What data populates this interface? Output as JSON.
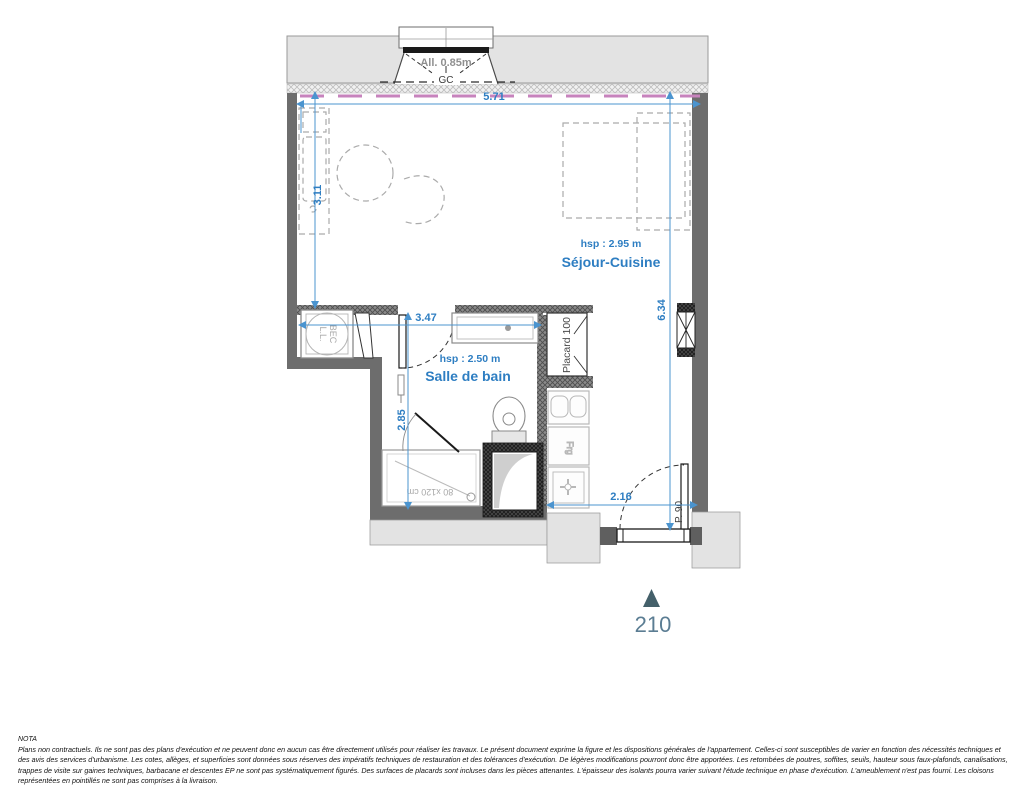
{
  "window": {
    "allege": "All. 0.85m",
    "vent": "GC"
  },
  "rooms": {
    "sejour_label": "Séjour-Cuisine",
    "sejour_hsp": "hsp : 2.95 m",
    "bath_label": "Salle de bain",
    "bath_hsp": "hsp : 2.50 m",
    "placard_label": "Placard 100",
    "fridge_label": "Frg",
    "bec_line1": "BEC",
    "bec_line2": "L.L.",
    "shower_label": "80 x120 cm",
    "entry_door_label": "P. 90"
  },
  "dimensions": {
    "width_top": "5.71",
    "height_left": "3.11",
    "height_right": "6.34",
    "bath_width": "3.47",
    "bath_height": "2.85",
    "entry_width": "2.16"
  },
  "unit_marker": {
    "number": "210"
  },
  "colors": {
    "dimension_blue": "#2e7ec2",
    "wall_dark": "#6d6d6d",
    "wall_light": "#e3e3e3",
    "accent_pink": "#c783bd",
    "marker_teal": "#44606a"
  },
  "nota": {
    "title": "NOTA",
    "body": "Plans non contractuels. Ils ne sont pas des plans d'exécution et ne peuvent donc en aucun cas être directement utilisés pour réaliser les travaux. Le présent document exprime la figure et les dispositions générales de l'appartement. Celles-ci sont susceptibles de varier en fonction des nécessités techniques et des avis des services d'urbanisme. Les cotes, allèges, et superficies sont données sous réserves des impératifs techniques de restauration et des tolérances d'exécution. De légères modifications pourront donc être apportées. Les retombées de poutres, soffites, seuils, hauteur sous faux-plafonds, canalisations, trappes de visite sur gaines techniques, barbacane et descentes EP ne sont pas systématiquement figurés. Des surfaces de placards sont incluses dans les pièces attenantes. L'épaisseur des isolants pourra varier suivant l'étude technique en phase d'exécution. L'ameublement n'est pas fourni. Les cloisons représentées en pointillés ne sont pas comprises à la livraison."
  }
}
